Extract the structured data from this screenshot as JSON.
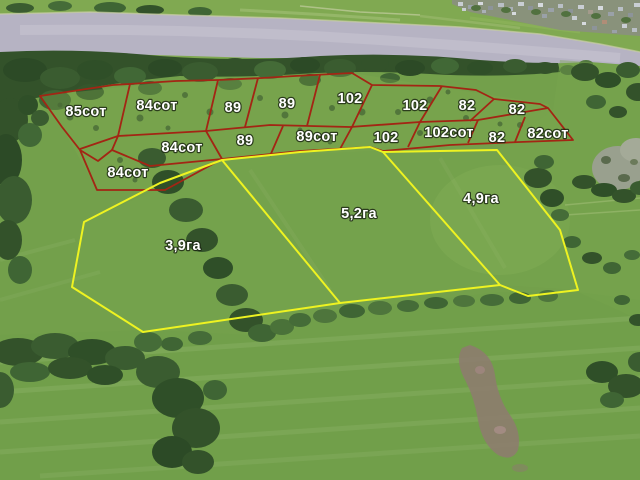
{
  "colors": {
    "field_green": "#73a04b",
    "far_bank_green": "#80a951",
    "water": "#b6b3c3",
    "tree_green": "#33522a",
    "small_lot_outline": "#a32514",
    "large_lot_outline": "#eef321",
    "label_text": "#ffffff"
  },
  "parcels": {
    "small_lots": [
      {
        "label": "85сот"
      },
      {
        "label": "84сот"
      },
      {
        "label": "89"
      },
      {
        "label": "89"
      },
      {
        "label": "102"
      },
      {
        "label": "102"
      },
      {
        "label": "82"
      },
      {
        "label": "82"
      },
      {
        "label": "84сот"
      },
      {
        "label": "89"
      },
      {
        "label": "89сот"
      },
      {
        "label": "102"
      },
      {
        "label": "102сот"
      },
      {
        "label": "82"
      },
      {
        "label": "82сот"
      },
      {
        "label": "84сот"
      }
    ],
    "large_lots": [
      {
        "label": "3,9га"
      },
      {
        "label": "5,2га"
      },
      {
        "label": "4,9га"
      }
    ]
  }
}
